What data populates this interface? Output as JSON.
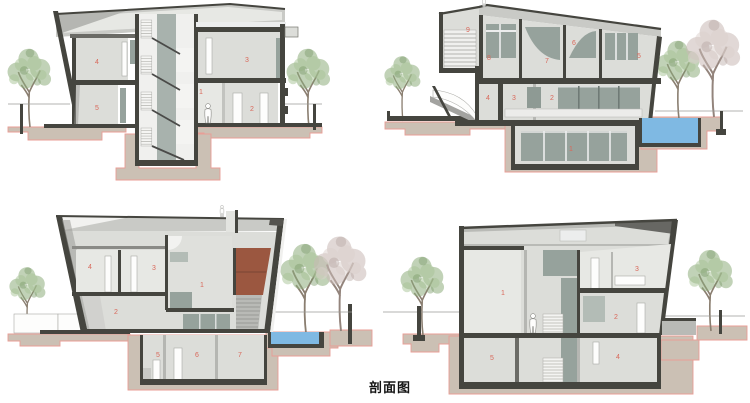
{
  "caption": "剖面图",
  "colors": {
    "structure": "#45453f",
    "wall": "#dcddd9",
    "wall_light": "#e7e8e4",
    "glazing": "#96a29c",
    "foundation": "#cbc0b4",
    "foundation_outline": "#e89e96",
    "pool": "#7fb9e3",
    "terracotta": "#9b5740",
    "label": "#d9685a"
  },
  "sections": [
    {
      "id": "top-left",
      "rooms": [
        "4",
        "5",
        "3",
        "1",
        "2"
      ]
    },
    {
      "id": "top-right",
      "rooms": [
        "9",
        "8",
        "7",
        "6",
        "5",
        "4",
        "3",
        "2",
        "1"
      ]
    },
    {
      "id": "bottom-left",
      "rooms": [
        "4",
        "3",
        "1",
        "2",
        "5",
        "6",
        "7"
      ]
    },
    {
      "id": "bottom-right",
      "rooms": [
        "1",
        "3",
        "2",
        "5",
        "4"
      ]
    }
  ]
}
